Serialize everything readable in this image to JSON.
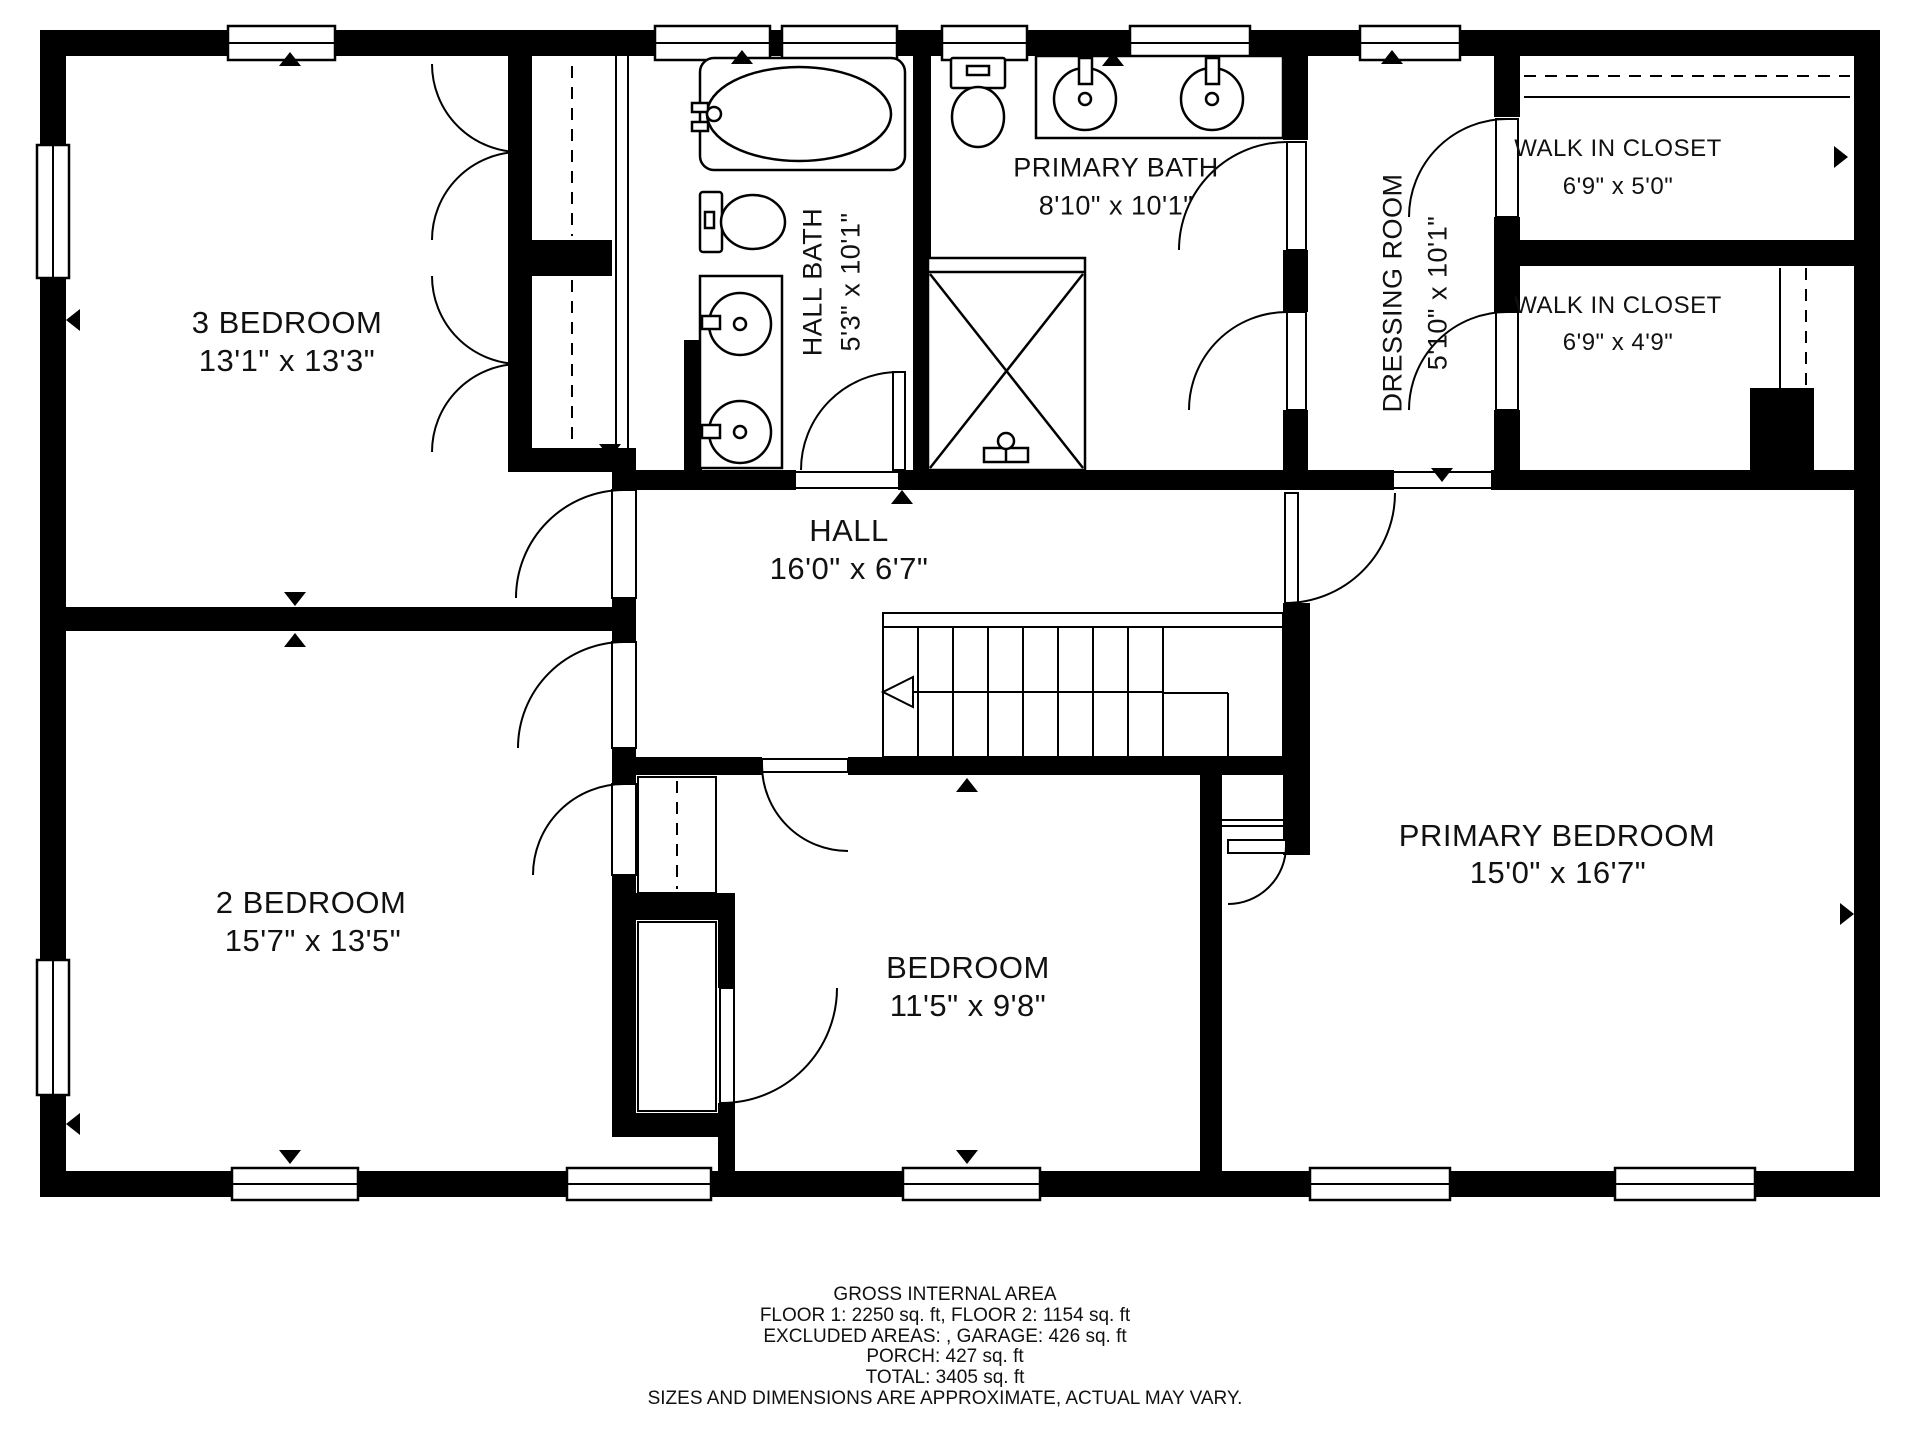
{
  "rooms": {
    "bedroom3": {
      "name": "3 BEDROOM",
      "dims": "13'1\" x 13'3\""
    },
    "bedroom2": {
      "name": "2 BEDROOM",
      "dims": "15'7\" x 13'5\""
    },
    "bedroom": {
      "name": "BEDROOM",
      "dims": "11'5\" x 9'8\""
    },
    "primary_bedroom": {
      "name": "PRIMARY BEDROOM",
      "dims": "15'0\" x 16'7\""
    },
    "hall": {
      "name": "HALL",
      "dims": "16'0\" x 6'7\""
    },
    "hall_bath": {
      "name": "HALL BATH",
      "dims": "5'3\" x 10'1\""
    },
    "primary_bath": {
      "name": "PRIMARY BATH",
      "dims": "8'10\" x 10'1\""
    },
    "dressing": {
      "name": "DRESSING ROOM",
      "dims": "5'10\" x 10'1\""
    },
    "wic1": {
      "name": "WALK IN CLOSET",
      "dims": "6'9\" x 5'0\""
    },
    "wic2": {
      "name": "WALK IN CLOSET",
      "dims": "6'9\" x 4'9\""
    }
  },
  "footer": {
    "line1": "GROSS INTERNAL AREA",
    "line2": "FLOOR 1: 2250 sq. ft, FLOOR 2: 1154 sq. ft",
    "line3": "EXCLUDED AREAS: , GARAGE: 426 sq. ft",
    "line4": "PORCH: 427 sq. ft",
    "line5": "TOTAL: 3405 sq. ft",
    "line6": "SIZES AND DIMENSIONS ARE APPROXIMATE, ACTUAL MAY VARY."
  },
  "icons": {
    "fixtures": [
      "bathtub-icon",
      "toilet-icon",
      "sink-icon",
      "double-vanity-icon",
      "shower-icon",
      "stairs-icon",
      "window-icon",
      "door-swing-icon",
      "closet-rail-icon"
    ]
  },
  "colors": {
    "wall": "#000000",
    "background": "#ffffff",
    "text": "#111111"
  }
}
